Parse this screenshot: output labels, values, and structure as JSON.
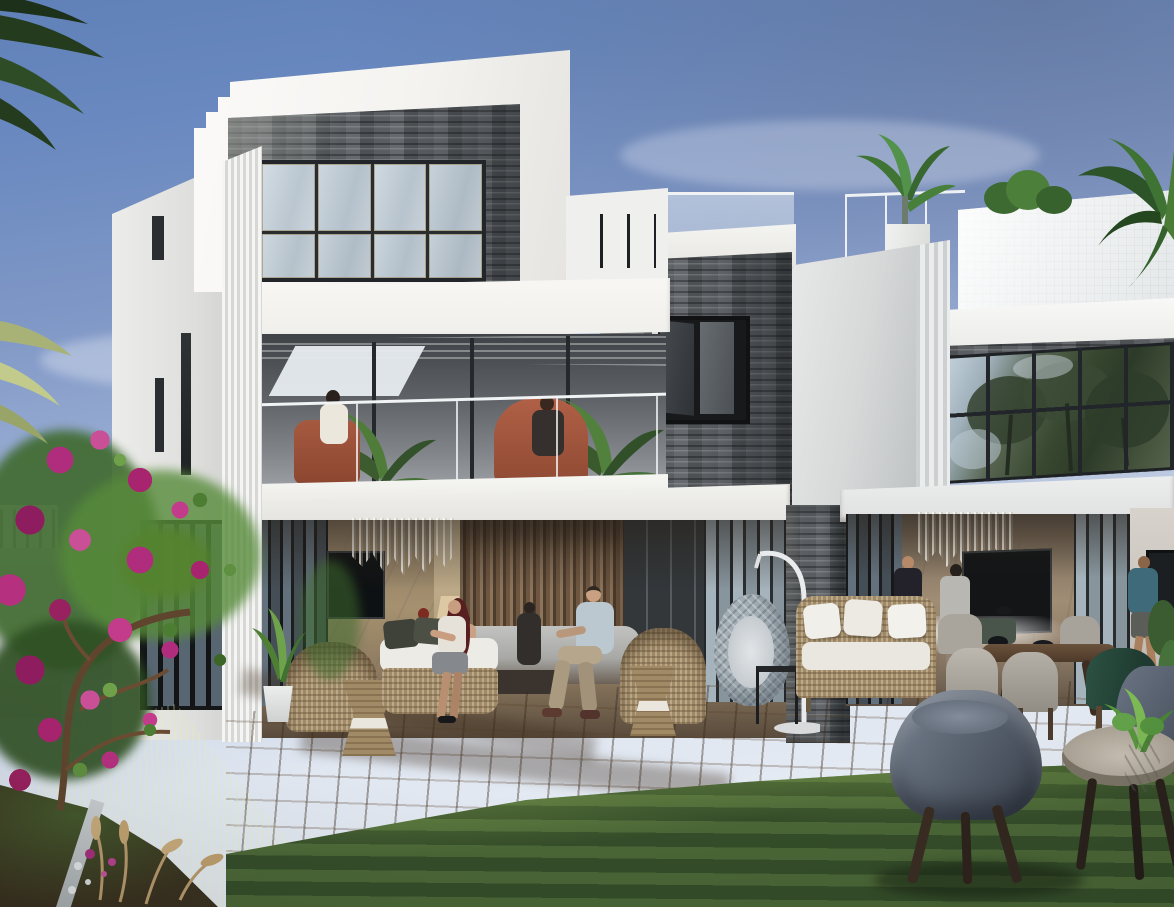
{
  "meta": {
    "domain": "Natural-Image",
    "title": "Architectural rendering of modern twin villas with garden terrace at dusk",
    "people_count": 11
  },
  "palette": {
    "sky_top": "#6484bc",
    "sky_horizon": "#e8edf3",
    "wall_white": "#f6f5f2",
    "wall_shaded": "#cfd1d0",
    "stone_dark": "#45494d",
    "stone_light": "#8e908c",
    "glass_frame": "#23262a",
    "glass_sky": "#cdd7df",
    "glass_trees": "#3e4c39",
    "deck_sun": "#a98a69",
    "deck_shadow": "#6a523d",
    "lawn_sun": "#8aa751",
    "lawn_shadow": "#35532c",
    "bougainvillea": "#b12879",
    "foliage": "#4f7d36",
    "egg_chair": "#9fabb3",
    "barrel_chair": "#5b6472",
    "rust_chair": "#a65a40",
    "cushion_white": "#f1efe9"
  },
  "scene": {
    "sky": {
      "label": "Clear blue sky with soft haze"
    },
    "left_villa": {
      "label": "Three-storey white villa with stone accents",
      "top_floor": {
        "label": "Stone-clad upper lounge with bronze-framed picture window"
      },
      "balcony": {
        "label": "First-floor balcony, glass balustrade, two guests on rust armchairs, potted palms"
      },
      "ground_floor": {
        "label": "Open lounge with marble TV wall, glass chandelier and guests"
      }
    },
    "stone_tower": {
      "label": "Central slate-clad tower with open casement window"
    },
    "right_villa": {
      "label": "Adjoining villa with rooftop terrace",
      "roof_terrace": {
        "label": "Glass-railed roof terrace with planters and palms"
      },
      "curtain_wall": {
        "label": "Double-height glazing reflecting garden trees"
      },
      "ground_floor": {
        "label": "Lounge with chandelier and wall art, guests inside"
      }
    },
    "garden": {
      "label": "Lawn and timber deck garden",
      "bougainvillea": {
        "label": "Magenta bougainvillea tree"
      },
      "flower_bed": {
        "label": "Planting bed with pink flowers and dry grasses"
      },
      "deck": {
        "label": "Timber deck terrace"
      },
      "lawn": {
        "label": "Striped green lawn"
      }
    },
    "furniture": {
      "egg_chair": {
        "label": "Hanging rattan egg chair on stand"
      },
      "rattan_sofa": {
        "label": "Rattan sofa with white cushions"
      },
      "dining_set": {
        "label": "Outdoor dining table with upholstered chairs"
      },
      "lounge_group": {
        "label": "Rattan lounge chairs with drum side tables"
      },
      "barrel_chair": {
        "label": "Grey barrel armchair on lawn"
      },
      "coffee_table": {
        "label": "Round stone coffee table with potted plant"
      }
    },
    "people": [
      {
        "label": "Two women chatting on the balcony"
      },
      {
        "label": "Woman with long auburn hair on deck bench"
      },
      {
        "label": "Man in pale polo on rattan chair"
      },
      {
        "label": "Guests in the left lounge"
      },
      {
        "label": "Man in dark suit holding a drink"
      },
      {
        "label": "Man in grey shirt viewing wall art"
      },
      {
        "label": "Man in teal T-shirt walking on terrace"
      }
    ]
  }
}
